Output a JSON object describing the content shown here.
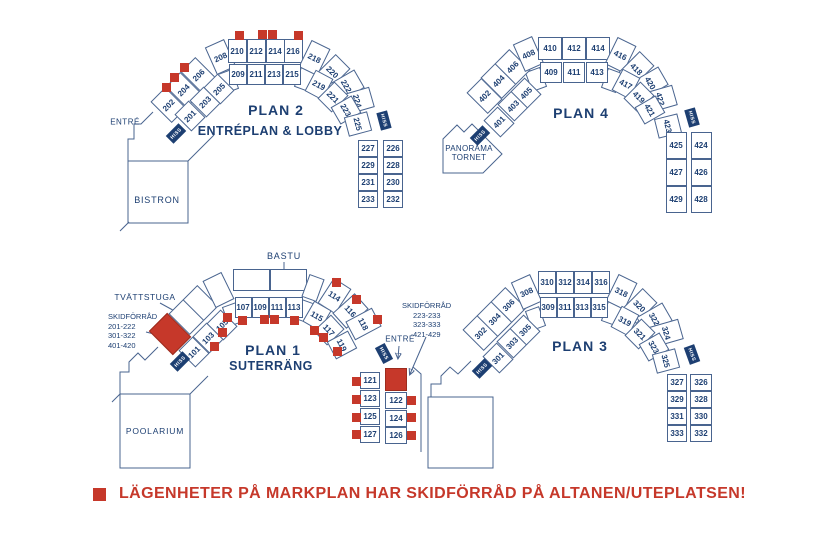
{
  "hiss_label": "HISS",
  "legend": {
    "text": "LÄGENHETER PÅ MARKPLAN HAR SKIDFÖRRÅD PÅ ALTANEN/UTEPLATSEN!"
  },
  "colors": {
    "navy": "#1d3f72",
    "red": "#c6382a",
    "line": "#49648f"
  },
  "plans": {
    "plan2": {
      "title": "PLAN 2",
      "subtitle": "ENTRÉPLAN & LOBBY",
      "entre_label": "ENTRÉ",
      "bistron_label": "BISTRON",
      "outer": [
        "202",
        "204",
        "206",
        "208",
        "210",
        "212",
        "214",
        "216",
        "218",
        "220",
        "222",
        "224"
      ],
      "inner": [
        "201",
        "203",
        "205",
        "209",
        "211",
        "213",
        "215",
        "219",
        "221",
        "223",
        "225"
      ],
      "col_left": [
        "227",
        "229",
        "231",
        "233"
      ],
      "col_right": [
        "226",
        "228",
        "230",
        "232"
      ]
    },
    "plan4": {
      "title": "PLAN 4",
      "panorama_label": "PANORAMA TORNET",
      "outer": [
        "402",
        "404",
        "406",
        "408",
        "410",
        "412",
        "414",
        "416",
        "418",
        "420",
        "422"
      ],
      "inner": [
        "401",
        "403",
        "405",
        "409",
        "411",
        "413",
        "417",
        "419",
        "421",
        "423"
      ],
      "col_left": [
        "425",
        "427",
        "429"
      ],
      "col_right": [
        "424",
        "426",
        "428"
      ]
    },
    "plan1": {
      "title": "PLAN 1",
      "subtitle": "SUTERRÄNG",
      "bastu_label": "BASTU",
      "tvattstuga_label": "TVÄTTSTUGA",
      "entre_label": "ENTRÉ",
      "poolarium_label": "POOLARIUM",
      "skidforrad_left": {
        "title": "SKIDFÖRRÅD",
        "lines": [
          "201-222",
          "301-322",
          "401-420"
        ]
      },
      "skidforrad_right": {
        "title": "SKIDFÖRRÅD",
        "lines": [
          "223-233",
          "323-333",
          "421-429"
        ]
      },
      "outer": [
        "114",
        "116",
        "118"
      ],
      "inner": [
        "101",
        "103",
        "105",
        "107",
        "109",
        "111",
        "113",
        "115",
        "117",
        "119"
      ],
      "col_left": [
        "121",
        "123",
        "125",
        "127"
      ],
      "col_right": [
        "122",
        "124",
        "126"
      ]
    },
    "plan3": {
      "title": "PLAN 3",
      "outer": [
        "302",
        "304",
        "306",
        "308",
        "310",
        "312",
        "314",
        "316",
        "318",
        "320",
        "322",
        "324"
      ],
      "inner": [
        "301",
        "303",
        "305",
        "309",
        "311",
        "313",
        "315",
        "319",
        "321",
        "323",
        "325"
      ],
      "col_left": [
        "327",
        "329",
        "331",
        "333"
      ],
      "col_right": [
        "326",
        "328",
        "330",
        "332"
      ]
    }
  }
}
